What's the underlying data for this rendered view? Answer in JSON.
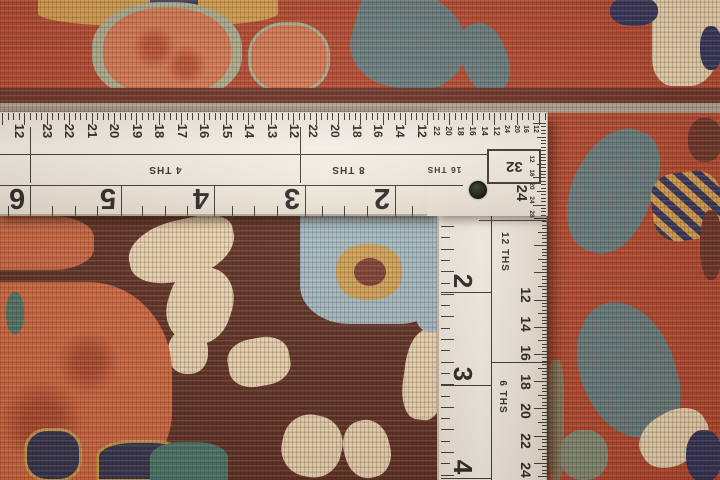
{
  "subject": "L-square ruler lying on an oriental rug",
  "ruler": {
    "corner_scale_label": "32",
    "horizontal_arm": {
      "leading_number": "12",
      "sections": [
        {
          "label": "4 THS",
          "numbers": [
            "23",
            "22",
            "21",
            "20",
            "19",
            "18",
            "17",
            "16",
            "15",
            "14",
            "13",
            "12"
          ]
        },
        {
          "label": "8 THS",
          "numbers": [
            "22",
            "20",
            "18",
            "16",
            "14",
            "12"
          ]
        },
        {
          "label": "16 THS",
          "numbers": [
            "22",
            "20",
            "18",
            "16",
            "14",
            "12"
          ]
        },
        {
          "label": "32",
          "numbers": [
            "24",
            "20",
            "16",
            "12"
          ]
        }
      ],
      "inch_numbers": [
        "6",
        "5",
        "4",
        "3",
        "2"
      ]
    },
    "vertical_arm": {
      "sections": [
        {
          "label": "12 THS"
        },
        {
          "label": "6 THS"
        }
      ],
      "top_number": "24",
      "inner_numbers": [
        "12",
        "14",
        "16",
        "18",
        "20",
        "22",
        "24"
      ],
      "inch_numbers": [
        "2",
        "3",
        "4"
      ],
      "fine_numbers": [
        "12",
        "16",
        "20",
        "24",
        "28"
      ]
    }
  },
  "colors": {
    "ruler_white": "#f3eee6",
    "ruler_line": "#3f3b36",
    "rug_rust": "#b8482e",
    "rug_salmon": "#d97a52",
    "rug_coral": "#cf6740",
    "rug_gold": "#d6a24c",
    "rug_sage": "#a9b394",
    "rug_powder_blue": "#9cbecb",
    "rug_slate_teal": "#5f8084",
    "rug_teal_green": "#46796c",
    "rug_navy": "#2b3560",
    "rug_maroon": "#6a3328",
    "rug_dark_maroon": "#5a2e23",
    "rug_cream": "#e9d9b4"
  }
}
